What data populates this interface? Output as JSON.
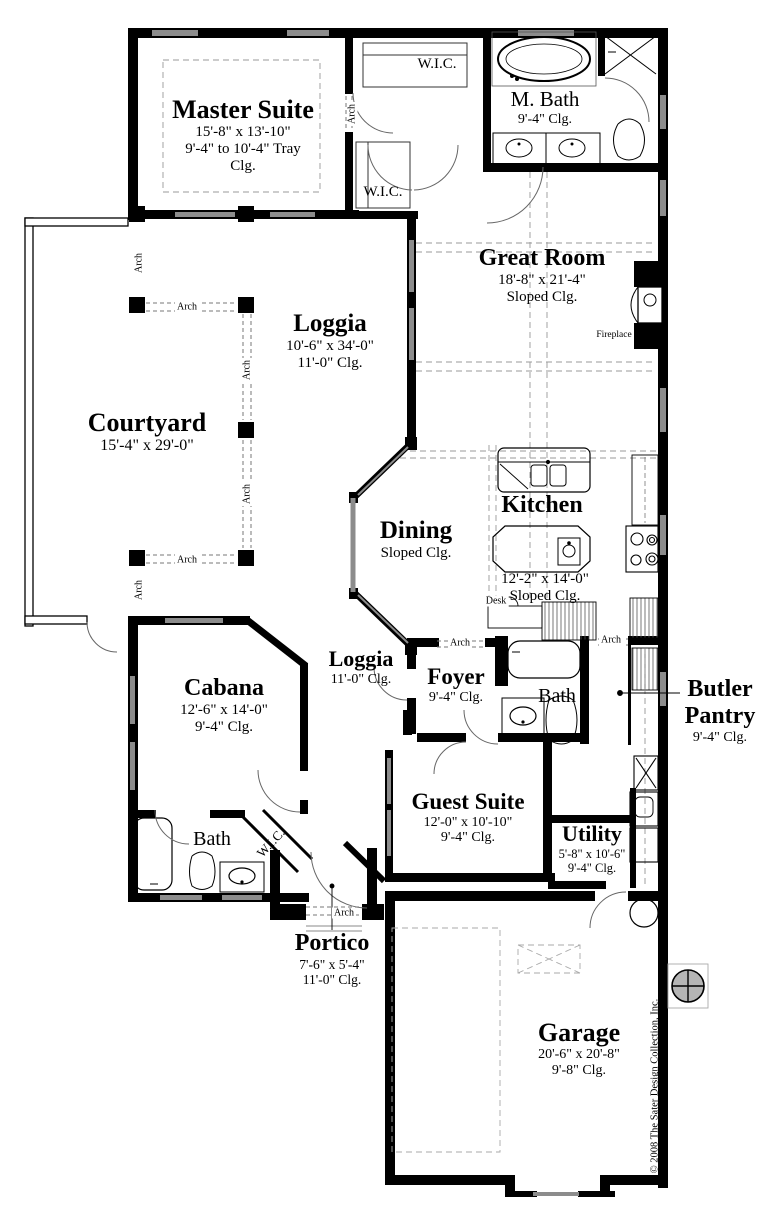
{
  "document": {
    "copyright": "© 2008 The Sater Design Collection, Inc."
  },
  "annotations": {
    "arch": "Arch",
    "fireplace": "Fireplace",
    "desk": "Desk"
  },
  "rooms": {
    "master_suite": {
      "name": "Master Suite",
      "dims": "15'-8\" x 13'-10\"",
      "ceiling_line1": "9'-4\" to 10'-4\" Tray",
      "ceiling_line2": "Clg."
    },
    "wic_master_upper": {
      "name": "W.I.C."
    },
    "wic_master_lower": {
      "name": "W.I.C."
    },
    "master_bath": {
      "name": "M. Bath",
      "ceiling": "9'-4\" Clg."
    },
    "great_room": {
      "name": "Great Room",
      "dims": "18'-8\" x 21'-4\"",
      "ceiling": "Sloped Clg."
    },
    "loggia": {
      "name": "Loggia",
      "dims": "10'-6\" x 34'-0\"",
      "ceiling": "11'-0\" Clg."
    },
    "courtyard": {
      "name": "Courtyard",
      "dims": "15'-4\" x 29'-0\""
    },
    "kitchen": {
      "name": "Kitchen",
      "dims": "12'-2\" x 14'-0\"",
      "ceiling": "Sloped Clg."
    },
    "dining": {
      "name": "Dining",
      "ceiling": "Sloped Clg."
    },
    "cabana": {
      "name": "Cabana",
      "dims": "12'-6\" x 14'-0\"",
      "ceiling": "9'-4\" Clg."
    },
    "loggia_entry": {
      "name": "Loggia",
      "ceiling": "11'-0\" Clg."
    },
    "foyer": {
      "name": "Foyer",
      "ceiling": "9'-4\" Clg."
    },
    "bath_guest": {
      "name": "Bath"
    },
    "butler_pantry": {
      "name_line1": "Butler",
      "name_line2": "Pantry",
      "ceiling": "9'-4\" Clg."
    },
    "guest_suite": {
      "name": "Guest Suite",
      "dims": "12'-0\" x 10'-10\"",
      "ceiling": "9'-4\" Clg."
    },
    "utility": {
      "name": "Utility",
      "dims": "5'-8\" x 10'-6\"",
      "ceiling": "9'-4\" Clg."
    },
    "bath_cabana": {
      "name": "Bath"
    },
    "wic_cabana": {
      "name": "W.I.C."
    },
    "portico": {
      "name": "Portico",
      "dims": "7'-6\" x 5'-4\"",
      "ceiling": "11'-0\" Clg."
    },
    "garage": {
      "name": "Garage",
      "dims": "20'-6\" x 20'-8\"",
      "ceiling": "9'-8\" Clg."
    }
  },
  "colors": {
    "wall": "#000000",
    "background": "#ffffff",
    "window": "#8c8c8c",
    "dashed": "#999999"
  }
}
